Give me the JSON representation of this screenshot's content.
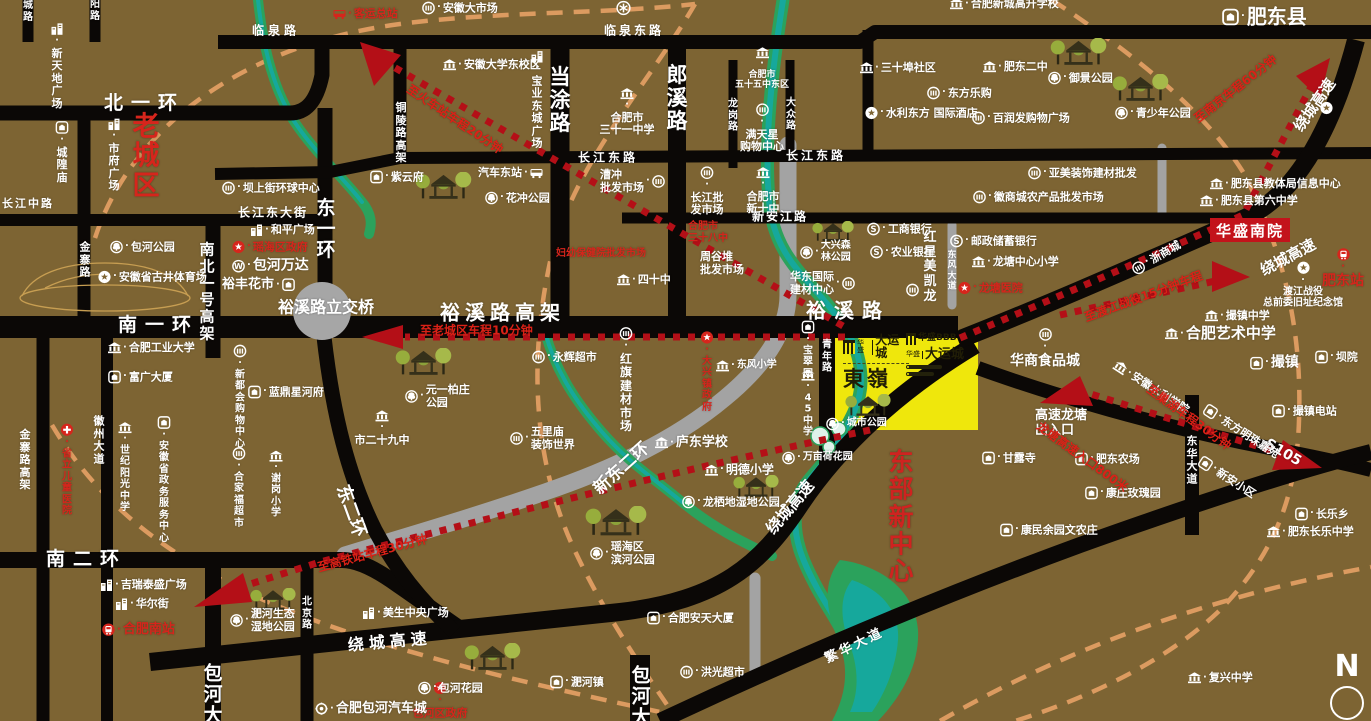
{
  "colors": {
    "background": "#7d6433",
    "road": "#0b0806",
    "river_green": "#2ba25c",
    "river_teal": "#16a89c",
    "route_red": "#b40f17",
    "text_red": "#d6251c",
    "route_text_red": "#db2117",
    "highlight_yellow": "#efe70c",
    "gray_road": "#a3a3a3",
    "orange_dash": "#dc9b60"
  },
  "property": {
    "complex1": {
      "brand_small": "华盛",
      "brand": "大运城",
      "name": "東嶺"
    },
    "complex2": {
      "logo": "华盛BBB",
      "brand_small": "华盛",
      "brand": "大运城"
    },
    "south_annex": "华盛南院"
  },
  "compass": {
    "letter": "N"
  },
  "road_labels": [
    {
      "t": "临泉路",
      "x": 252,
      "y": 31,
      "fs": 12,
      "ls": 4,
      "b": 1
    },
    {
      "t": "临泉东路",
      "x": 604,
      "y": 31,
      "fs": 12,
      "ls": 3,
      "b": 1
    },
    {
      "t": "北一环",
      "x": 104,
      "y": 104,
      "fs": 19,
      "ls": 8,
      "b": 1
    },
    {
      "t": "长江中路",
      "x": 2,
      "y": 204,
      "fs": 11,
      "ls": 2,
      "b": 1
    },
    {
      "t": "长江东大街",
      "x": 238,
      "y": 213,
      "fs": 12,
      "ls": 2,
      "b": 1
    },
    {
      "t": "长江东路",
      "x": 578,
      "y": 158,
      "fs": 12,
      "ls": 3,
      "b": 1
    },
    {
      "t": "长江东路",
      "x": 786,
      "y": 156,
      "fs": 12,
      "ls": 3,
      "b": 1
    },
    {
      "t": "新安江路",
      "x": 752,
      "y": 217,
      "fs": 12,
      "ls": 2,
      "b": 1
    },
    {
      "t": "当涂路",
      "x": 560,
      "y": 100,
      "fs": 21,
      "v": 1,
      "b": 1
    },
    {
      "t": "郎溪路",
      "x": 677,
      "y": 98,
      "fs": 21,
      "v": 1,
      "b": 1
    },
    {
      "t": "龙岗路",
      "x": 733,
      "y": 116,
      "fs": 10,
      "v": 1
    },
    {
      "t": "大众路",
      "x": 791,
      "y": 115,
      "fs": 10,
      "v": 1
    },
    {
      "t": "铜陵路高架",
      "x": 401,
      "y": 133,
      "fs": 11,
      "v": 1
    },
    {
      "t": "东一环",
      "x": 326,
      "y": 230,
      "fs": 19,
      "v": 1,
      "b": 1
    },
    {
      "t": "金寨路",
      "x": 85,
      "y": 260,
      "fs": 11,
      "v": 1
    },
    {
      "t": "南北一号高架",
      "x": 207,
      "y": 292,
      "fs": 15,
      "v": 1,
      "b": 1
    },
    {
      "t": "南一环",
      "x": 118,
      "y": 326,
      "fs": 19,
      "ls": 8,
      "b": 1
    },
    {
      "t": "裕溪路立交桥",
      "x": 278,
      "y": 308,
      "fs": 16,
      "b": 1
    },
    {
      "t": "裕溪路高架",
      "x": 440,
      "y": 313,
      "fs": 20,
      "ls": 5,
      "b": 1
    },
    {
      "t": "裕溪路",
      "x": 806,
      "y": 311,
      "fs": 20,
      "ls": 8,
      "b": 1
    },
    {
      "t": "东二环",
      "x": 341,
      "y": 486,
      "fs": 18,
      "rot": 70,
      "b": 1
    },
    {
      "t": "新东二环",
      "x": 597,
      "y": 492,
      "fs": 17,
      "rot": -42,
      "b": 1
    },
    {
      "t": "绕城高速",
      "x": 770,
      "y": 532,
      "fs": 16,
      "rot": -50,
      "b": 1
    },
    {
      "t": "绕城高速",
      "x": 348,
      "y": 646,
      "fs": 16,
      "rot": -5,
      "ls": 5,
      "b": 1
    },
    {
      "t": "绕城高速",
      "x": 1262,
      "y": 272,
      "fs": 15,
      "rot": -28,
      "b": 1
    },
    {
      "t": "绕城高速",
      "x": 1298,
      "y": 130,
      "fs": 15,
      "rot": -55,
      "b": 1
    },
    {
      "t": "繁华大道",
      "x": 826,
      "y": 660,
      "fs": 13,
      "rot": -26,
      "ls": 3,
      "b": 1
    },
    {
      "t": "S105",
      "x": 1266,
      "y": 443,
      "fs": 14,
      "rot": 30,
      "b": 1
    },
    {
      "t": "青年路",
      "x": 827,
      "y": 357,
      "fs": 10,
      "v": 1
    },
    {
      "t": "东风大道",
      "x": 952,
      "y": 272,
      "fs": 9,
      "v": 1
    },
    {
      "t": "南二环",
      "x": 46,
      "y": 560,
      "fs": 19,
      "ls": 8,
      "b": 1
    },
    {
      "t": "北京路",
      "x": 307,
      "y": 614,
      "fs": 10,
      "v": 1
    },
    {
      "t": "徽州大道",
      "x": 99,
      "y": 440,
      "fs": 11,
      "v": 1
    },
    {
      "t": "金寨路高架",
      "x": 25,
      "y": 460,
      "fs": 11,
      "v": 1
    },
    {
      "t": "包河大道",
      "x": 213,
      "y": 706,
      "fs": 19,
      "v": 1,
      "b": 1
    },
    {
      "t": "包河大道",
      "x": 641,
      "y": 708,
      "fs": 19,
      "v": 1,
      "b": 1
    },
    {
      "t": "东华大道",
      "x": 1192,
      "y": 460,
      "fs": 11,
      "v": 1
    },
    {
      "t": "城路",
      "x": 28,
      "y": 12,
      "fs": 10,
      "v": 1
    },
    {
      "t": "阳路",
      "x": 95,
      "y": 11,
      "fs": 10,
      "v": 1
    }
  ],
  "route_labels": [
    {
      "t": "至老城区车程10分钟",
      "x": 420,
      "y": 331
    },
    {
      "t": "至火车站车程20分钟",
      "x": 408,
      "y": 88,
      "rot": 34
    },
    {
      "t": "至南京车程60分钟",
      "x": 1196,
      "y": 120,
      "rot": -38
    },
    {
      "t": "至渡江战役15分钟车程",
      "x": 1085,
      "y": 318,
      "rot": -20
    },
    {
      "t": "至巢湖车程30分钟",
      "x": 1148,
      "y": 388,
      "rot": 36
    },
    {
      "t": "龙塘高速入口800米",
      "x": 1038,
      "y": 425,
      "rot": 36
    },
    {
      "t": "至高铁站车程30分钟",
      "x": 318,
      "y": 568,
      "rot": -15
    }
  ],
  "places": [
    {
      "t": "客运总站",
      "x": 333,
      "y": 14,
      "ic": "bus",
      "c": "#d6251c",
      "b": 1,
      "dn": "bus-terminal"
    },
    {
      "t": "安徽大市场",
      "x": 422,
      "y": 8,
      "ic": "market"
    },
    {
      "t": "合肥新城高升学校",
      "x": 950,
      "y": 4,
      "ic": "inst"
    },
    {
      "t": "肥东县",
      "x": 1222,
      "y": 17,
      "ic": "town",
      "fs": 20,
      "b": 1,
      "is": 17,
      "dn": "feidong-county"
    },
    {
      "t": "新天地广场",
      "x": 57,
      "y": 66,
      "v": 1,
      "ic": "bldg"
    },
    {
      "t": "城隍庙",
      "x": 62,
      "y": 152,
      "v": 1,
      "ic": "town"
    },
    {
      "t": "市府广场",
      "x": 114,
      "y": 155,
      "v": 1,
      "ic": "bldg"
    },
    {
      "t": "老城区",
      "x": 146,
      "y": 157,
      "v": 1,
      "fs": 27,
      "b": 1,
      "c": "#d6251c",
      "dn": "old-town-label"
    },
    {
      "t": "安徽大学东校区",
      "x": 443,
      "y": 65,
      "ic": "inst"
    },
    {
      "t": "宝业东城广场",
      "x": 537,
      "y": 100,
      "v": 1,
      "ic": "bldg"
    },
    {
      "t": "",
      "lines": [
        "合肥市",
        "三十一中学"
      ],
      "x": 627,
      "y": 112,
      "ia": 1,
      "ic": "inst"
    },
    {
      "t": "",
      "lines": [
        "合肥市",
        "五十五中东区"
      ],
      "x": 762,
      "y": 69,
      "ia": 1,
      "ic": "inst",
      "fs": 9
    },
    {
      "t": "三十埠社区",
      "x": 860,
      "y": 68,
      "ic": "inst"
    },
    {
      "t": "肥东二中",
      "x": 983,
      "y": 67,
      "ic": "inst"
    },
    {
      "t": "御景公园",
      "x": 1048,
      "y": 78,
      "ic": "park"
    },
    {
      "t": "东方乐购",
      "x": 927,
      "y": 93,
      "ic": "market"
    },
    {
      "t": "水利东方 国际酒店",
      "x": 865,
      "y": 113,
      "ic": "star"
    },
    {
      "t": "百润发购物广场",
      "x": 972,
      "y": 118,
      "ic": "market"
    },
    {
      "t": "青少年公园",
      "x": 1115,
      "y": 113,
      "ic": "park"
    },
    {
      "t": "",
      "lines": [
        "满天星",
        "购物中心"
      ],
      "x": 762,
      "y": 128,
      "ia": 1,
      "ic": "market"
    },
    {
      "t": "亚美装饰建材批发",
      "x": 1028,
      "y": 173,
      "ic": "market"
    },
    {
      "t": "徽商城农产品批发市场",
      "x": 973,
      "y": 197,
      "ic": "market"
    },
    {
      "t": "肥东县教体局信息中心",
      "x": 1210,
      "y": 184,
      "ic": "inst"
    },
    {
      "t": "肥东县第六中学",
      "x": 1200,
      "y": 201,
      "ic": "inst"
    },
    {
      "t": "坝上街环球中心",
      "x": 222,
      "y": 188,
      "ic": "market"
    },
    {
      "t": "紫云府",
      "x": 370,
      "y": 177,
      "ic": "town"
    },
    {
      "t": "汽车东站",
      "x": 478,
      "y": 173,
      "ic": "bus",
      "ir": 1
    },
    {
      "t": "花冲公园",
      "x": 485,
      "y": 198,
      "ic": "park"
    },
    {
      "t": "",
      "lines": [
        "漕冲",
        "批发市场"
      ],
      "x": 600,
      "y": 181,
      "b": 1,
      "ic": "market",
      "ir": 1
    },
    {
      "t": "",
      "lines": [
        "长江批",
        "发市场"
      ],
      "x": 707,
      "y": 191,
      "ia": 1,
      "ic": "market",
      "b": 1
    },
    {
      "t": "",
      "lines": [
        "合肥市",
        "新十中"
      ],
      "x": 763,
      "y": 191,
      "ia": 1,
      "ic": "inst"
    },
    {
      "t": "和平广场",
      "x": 250,
      "y": 230,
      "ic": "bldg"
    },
    {
      "t": "瑶海区政府",
      "x": 232,
      "y": 247,
      "ic": "gov",
      "c": "#d6251c"
    },
    {
      "t": "包河万达",
      "x": 232,
      "y": 266,
      "ic": "wanda",
      "b": 1,
      "fs": 14
    },
    {
      "t": "裕丰花市",
      "x": 222,
      "y": 285,
      "ic": "town",
      "ir": 1,
      "b": 1,
      "fs": 13
    },
    {
      "t": "包河公园",
      "x": 110,
      "y": 247,
      "ic": "park"
    },
    {
      "t": "安徽省古井体育场",
      "x": 98,
      "y": 277,
      "ic": "star"
    },
    {
      "t": "",
      "lines": [
        "合肥市",
        "三十八中"
      ],
      "x": 688,
      "y": 233,
      "c": "#d6251c",
      "fs": 10
    },
    {
      "t": "妇幼保健院批发市场",
      "x": 556,
      "y": 254,
      "c": "#d6251c",
      "fs": 10
    },
    {
      "t": "四十中",
      "x": 617,
      "y": 280,
      "ic": "inst"
    },
    {
      "t": "",
      "lines": [
        "周谷堆",
        "批发市场"
      ],
      "x": 700,
      "y": 263,
      "fs": 11
    },
    {
      "t": "",
      "lines": [
        "大兴森",
        "林公园"
      ],
      "x": 800,
      "y": 252,
      "fs": 10,
      "ic": "park"
    },
    {
      "t": "",
      "lines": [
        "华东国际",
        "建材中心"
      ],
      "x": 790,
      "y": 283,
      "b": 1,
      "ic": "market",
      "ir": 1
    },
    {
      "t": "工商银行",
      "x": 867,
      "y": 229,
      "ic": "bank"
    },
    {
      "t": "农业银行",
      "x": 870,
      "y": 252,
      "ic": "bank"
    },
    {
      "t": "红星美凯龙",
      "x": 930,
      "y": 267,
      "v": 1,
      "b": 1,
      "fs": 13
    },
    {
      "t": "",
      "ic": "market",
      "x": 906,
      "y": 290
    },
    {
      "t": "邮政储蓄银行",
      "x": 950,
      "y": 241,
      "ic": "bank"
    },
    {
      "t": "龙塘中心小学",
      "x": 972,
      "y": 262,
      "ic": "inst"
    },
    {
      "t": "龙塘医院",
      "x": 958,
      "y": 288,
      "ic": "gov",
      "c": "#d6251c"
    },
    {
      "t": "",
      "lines": [
        "渡江战役",
        "总前委旧址纪念馆"
      ],
      "x": 1303,
      "y": 285,
      "ia": 1,
      "ic": "star",
      "fs": 10
    },
    {
      "t": "肥东站",
      "x": 1343,
      "y": 268,
      "ia": 1,
      "ic": "train",
      "c": "#d6251c",
      "b": 1,
      "fs": 14,
      "dn": "feidong-station"
    },
    {
      "t": "撮镇中学",
      "x": 1205,
      "y": 316,
      "ic": "inst"
    },
    {
      "t": "合肥艺术中学",
      "x": 1165,
      "y": 334,
      "ic": "inst",
      "b": 1,
      "fs": 15
    },
    {
      "t": "撮镇",
      "x": 1250,
      "y": 363,
      "ic": "town",
      "b": 1,
      "fs": 14
    },
    {
      "t": "坝院",
      "x": 1315,
      "y": 357,
      "ic": "town"
    },
    {
      "t": "撮镇电站",
      "x": 1272,
      "y": 411,
      "ic": "town"
    },
    {
      "t": "浙商城",
      "x": 1133,
      "y": 271,
      "rot": -30,
      "ic": "market"
    },
    {
      "t": "华商食品城",
      "x": 1045,
      "y": 348,
      "b": 1,
      "fs": 14,
      "ia": 1,
      "ic": "market"
    },
    {
      "t": "安徽水利学院",
      "x": 1115,
      "y": 364,
      "rot": 33,
      "ic": "inst"
    },
    {
      "t": "",
      "lines": [
        "高速龙塘",
        "出入口"
      ],
      "x": 1035,
      "y": 423,
      "b": 1,
      "fs": 13
    },
    {
      "t": "甘露寺",
      "x": 982,
      "y": 458,
      "ic": "town"
    },
    {
      "t": "肥东农场",
      "x": 1075,
      "y": 459,
      "ic": "town"
    },
    {
      "t": "康庄玫瑰园",
      "x": 1085,
      "y": 493,
      "ic": "town"
    },
    {
      "t": "康民余园文农庄",
      "x": 1000,
      "y": 530,
      "ic": "town"
    },
    {
      "t": "东方明珠嘉苑",
      "x": 1205,
      "y": 408,
      "rot": 33,
      "ic": "town"
    },
    {
      "t": "新安小区",
      "x": 1200,
      "y": 460,
      "rot": 33,
      "ic": "town"
    },
    {
      "t": "长乐乡",
      "x": 1295,
      "y": 514,
      "ic": "town"
    },
    {
      "t": "肥东长乐中学",
      "x": 1267,
      "y": 532,
      "ic": "inst"
    },
    {
      "t": "复兴中学",
      "x": 1188,
      "y": 678,
      "ic": "inst"
    },
    {
      "t": "东部新中心",
      "x": 901,
      "y": 517,
      "v": 1,
      "fs": 25,
      "b": 1,
      "c": "#cf2320",
      "dn": "east-new-center-label"
    },
    {
      "t": "永辉超市",
      "x": 532,
      "y": 357,
      "ic": "market"
    },
    {
      "t": "",
      "lines": [
        "元一柏庄",
        "公园"
      ],
      "x": 405,
      "y": 396,
      "ic": "park"
    },
    {
      "t": "市二十九中",
      "x": 382,
      "y": 428,
      "ia": 1,
      "ic": "inst"
    },
    {
      "t": "蓝鼎星河府",
      "x": 248,
      "y": 392,
      "ic": "town"
    },
    {
      "t": "新都会购物中心",
      "x": 240,
      "y": 397,
      "v": 1,
      "ic": "market",
      "fs": 10
    },
    {
      "t": "富广大厦",
      "x": 108,
      "y": 377,
      "ic": "town"
    },
    {
      "t": "合肥工业大学",
      "x": 108,
      "y": 348,
      "ic": "inst"
    },
    {
      "t": "世纪阳光中学",
      "x": 125,
      "y": 468,
      "v": 1,
      "ic": "inst",
      "fs": 10
    },
    {
      "t": "安徽省政务服务中心",
      "x": 164,
      "y": 480,
      "v": 1,
      "ic": "town",
      "fs": 10
    },
    {
      "t": "合家福超市",
      "x": 239,
      "y": 488,
      "v": 1,
      "ic": "market",
      "fs": 10
    },
    {
      "t": "谢岗小学",
      "x": 276,
      "y": 485,
      "v": 1,
      "ic": "inst",
      "fs": 10
    },
    {
      "t": "省立儿童医院",
      "x": 67,
      "y": 470,
      "v": 1,
      "ic": "med",
      "c": "#d6251c",
      "fs": 10
    },
    {
      "t": "",
      "lines": [
        "五里庙",
        "装饰世界"
      ],
      "x": 510,
      "y": 438,
      "b": 1,
      "ic": "market"
    },
    {
      "t": "红旗建材市场",
      "x": 626,
      "y": 380,
      "v": 1,
      "ic": "market",
      "fs": 12,
      "b": 1
    },
    {
      "t": "大兴镇政府",
      "x": 707,
      "y": 372,
      "v": 1,
      "ic": "gov",
      "c": "#d6251c",
      "fs": 10
    },
    {
      "t": "东风小学",
      "x": 716,
      "y": 366,
      "ic": "inst",
      "fs": 10
    },
    {
      "t": "庐东学校",
      "x": 655,
      "y": 443,
      "ic": "inst",
      "b": 1,
      "fs": 13
    },
    {
      "t": "明德小学",
      "x": 705,
      "y": 470,
      "ic": "inst",
      "b": 1,
      "fs": 12
    },
    {
      "t": "龙栖地湿地公园",
      "x": 682,
      "y": 502,
      "ic": "park"
    },
    {
      "t": "",
      "lines": [
        "瑶海区",
        "滨河公园"
      ],
      "x": 590,
      "y": 553,
      "ic": "park"
    },
    {
      "t": "万亩荷花园",
      "x": 782,
      "y": 458,
      "ic": "park",
      "fs": 10
    },
    {
      "t": "城市公园",
      "x": 826,
      "y": 424,
      "ic": "park",
      "fs": 10
    },
    {
      "t": "宝翠园",
      "x": 808,
      "y": 350,
      "v": 1,
      "ic": "town",
      "fs": 10
    },
    {
      "t": "45中学",
      "x": 808,
      "y": 404,
      "v": 1,
      "ic": "inst",
      "fs": 10
    },
    {
      "t": "吉瑞泰盛广场",
      "x": 100,
      "y": 585,
      "ic": "bldg"
    },
    {
      "t": "华尔街",
      "x": 115,
      "y": 604,
      "ic": "bldg"
    },
    {
      "t": "合肥南站",
      "x": 102,
      "y": 630,
      "ic": "train",
      "c": "#d6251c",
      "b": 1,
      "fs": 13,
      "dn": "hefei-south-station"
    },
    {
      "t": "",
      "lines": [
        "淝河生态",
        "湿地公园"
      ],
      "x": 230,
      "y": 620,
      "ic": "park"
    },
    {
      "t": "包河区政府",
      "x": 440,
      "y": 700,
      "ia": 1,
      "ic": "gov",
      "c": "#d6251c",
      "b": 1
    },
    {
      "t": "美生中央广场",
      "x": 362,
      "y": 613,
      "ic": "bldg"
    },
    {
      "t": "包河花园",
      "x": 418,
      "y": 688,
      "ic": "park"
    },
    {
      "t": "合肥包河汽车城",
      "x": 315,
      "y": 709,
      "ic": "gear",
      "b": 1,
      "fs": 13
    },
    {
      "t": "淝河镇",
      "x": 550,
      "y": 682,
      "ic": "town"
    },
    {
      "t": "洪光超市",
      "x": 680,
      "y": 672,
      "ic": "market"
    },
    {
      "t": "合肥安天大厦",
      "x": 647,
      "y": 618,
      "ic": "town"
    },
    {
      "t": "",
      "ic": "metro",
      "x": 616,
      "y": 8,
      "is": 15
    },
    {
      "t": "",
      "ic": "star",
      "x": 1320,
      "y": 108
    }
  ]
}
